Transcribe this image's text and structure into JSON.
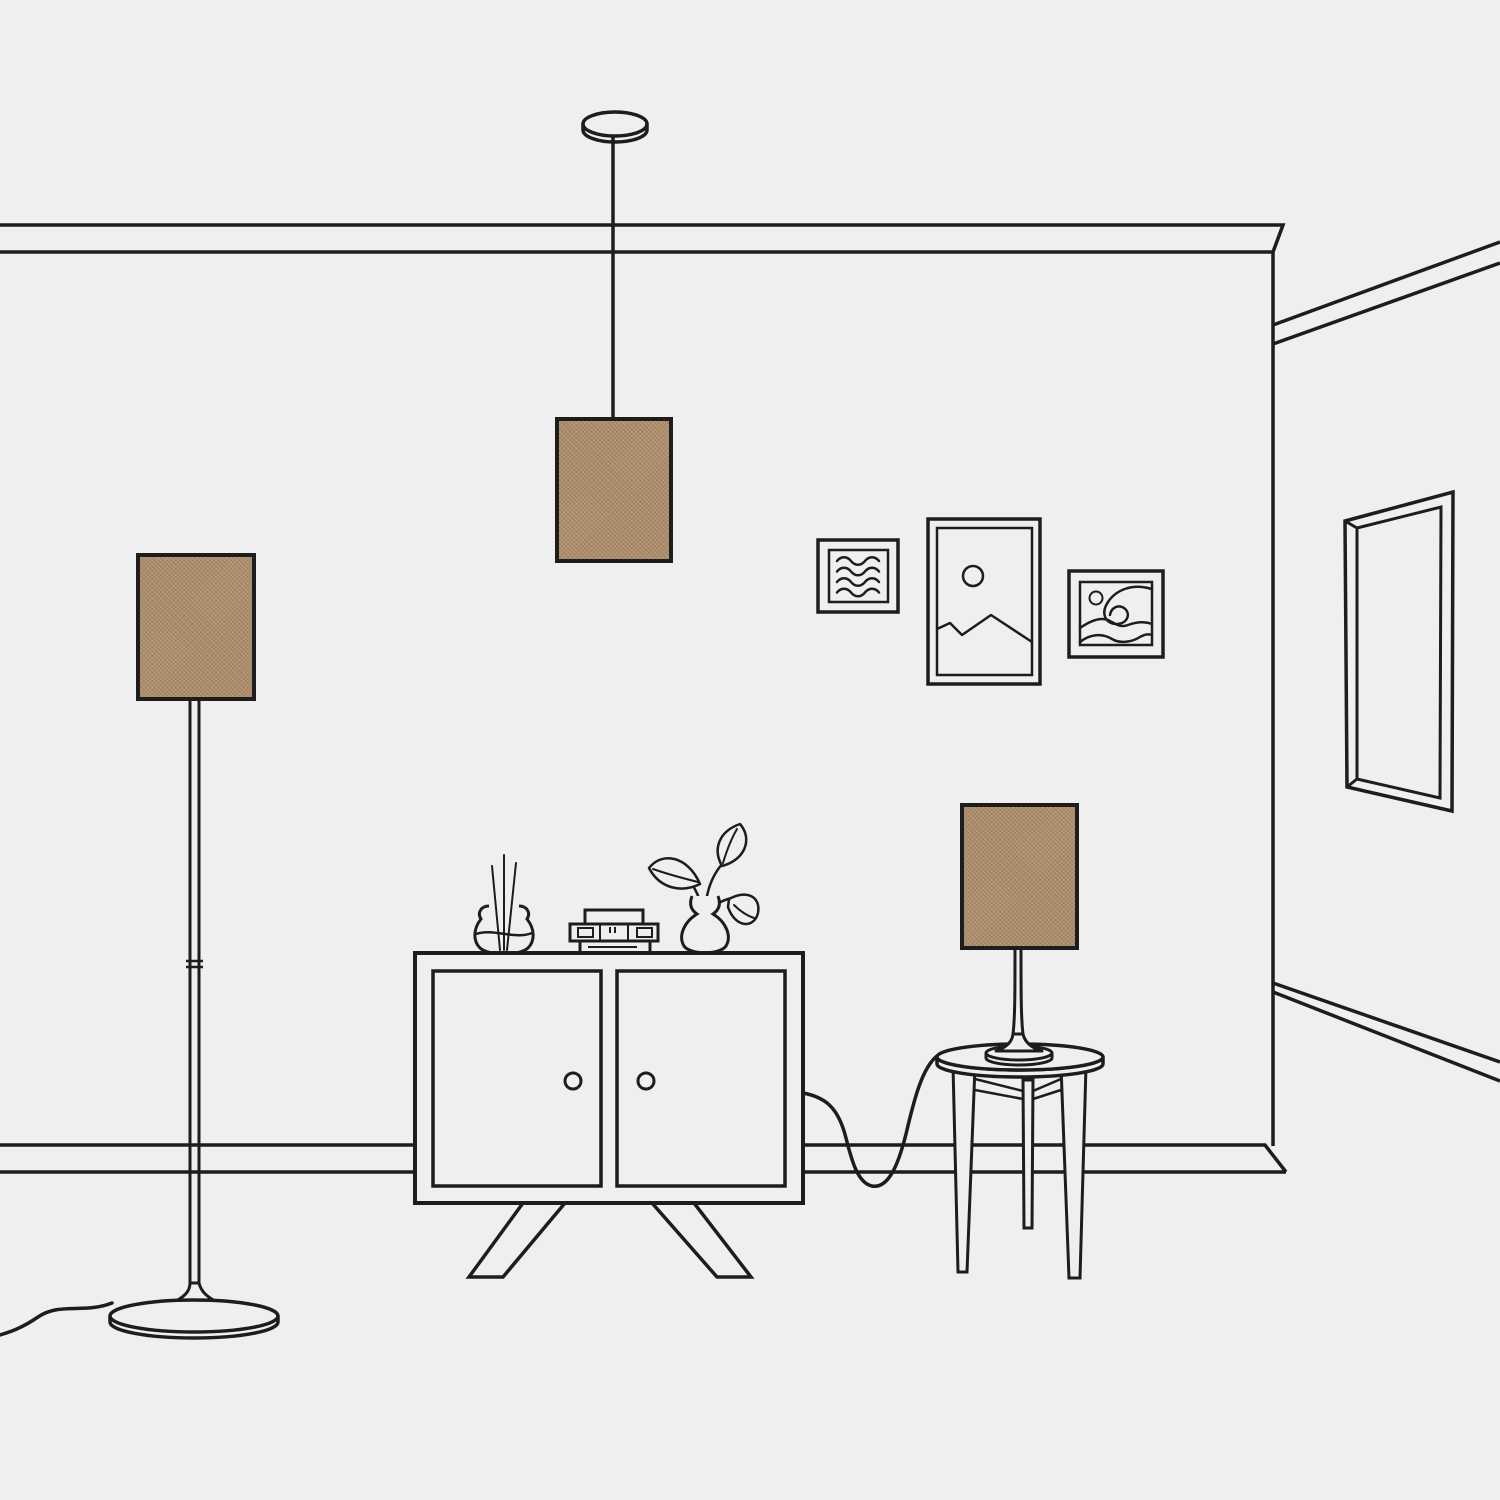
{
  "colors": {
    "background": "#efefef",
    "line": "#1d1d1d",
    "lampshade": "#ac8b68"
  },
  "scene": {
    "description": "Minimal line-art illustration of a living-room corner featuring three matching tan woven-fabric lampshades on a pendant lamp, a floor lamp and a table lamp, with a two-door cabinet, decor objects, gallery wall frames, a round side table and a tall mirror.",
    "room": {
      "label": "Room corner with crown molding, corner wall edge and baseboard"
    },
    "objects": [
      {
        "id": "pendant-lamp",
        "label": "Pendant lamp with tan rectangular shade hanging by a cord from a round ceiling mount"
      },
      {
        "id": "floor-lamp",
        "label": "Floor lamp with tan rectangular shade, slim jointed pole, round trumpet base and trailing power cord"
      },
      {
        "id": "table-lamp",
        "label": "Table lamp with tan rectangular shade and slender stem on a round base"
      },
      {
        "id": "gallery-frames",
        "label": "Gallery wall of three framed artworks: squiggle lines, mountain with sun, breaking wave with sun"
      },
      {
        "id": "wall-mirror",
        "label": "Tall rectangular mirror hung on the right-hand wall in perspective"
      },
      {
        "id": "cabinet",
        "label": "Two-door sideboard cabinet with round knobs and splayed angled legs"
      },
      {
        "id": "reed-diffuser",
        "label": "Glass reed diffuser with three scent sticks"
      },
      {
        "id": "media-stack",
        "label": "Small stack of boxes / mini radio on the cabinet top"
      },
      {
        "id": "plant-vase",
        "label": "Curvy vase holding a three-leaf plant"
      },
      {
        "id": "side-table",
        "label": "Round three-legged side table with cross stretchers; lamp cord loops down to the wall"
      }
    ],
    "lampshade_count": 3,
    "lampshade_texture": "woven fabric"
  }
}
